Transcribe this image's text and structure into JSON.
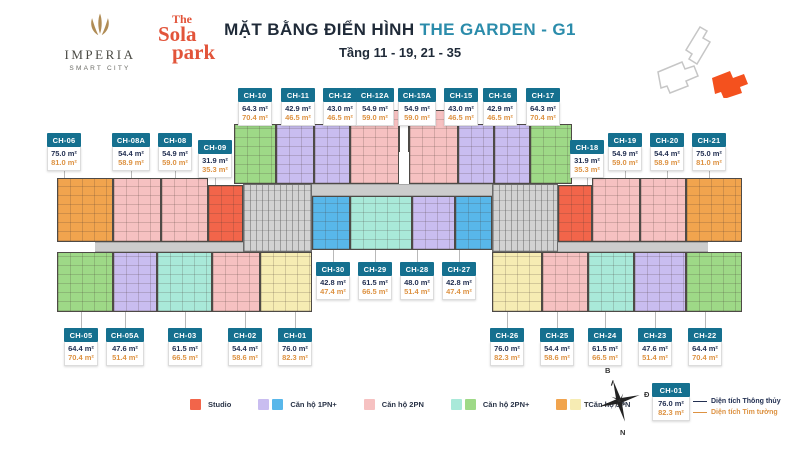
{
  "header": {
    "imperia_name": "IMPERIA",
    "imperia_sub": "SMART CITY",
    "sola_l1": "The",
    "sola_l2": "Sola",
    "sola_l3": "park",
    "title_black": "MẶT BẰNG ĐIỂN HÌNH",
    "title_teal": "THE GARDEN - G1",
    "subtitle": "Tầng 11 - 19, 21 - 35"
  },
  "palette": {
    "studio": "#f2654a",
    "1pn_purple": "#c9bdf0",
    "1pn_blue": "#58b7ea",
    "2pn_pink": "#f6c1c1",
    "2pnp_cyan": "#a9e9d9",
    "2pnp_green": "#9ed987",
    "3pn_orange": "#f1a44e",
    "3pn_yellow": "#f6ecb3",
    "label_teal": "#15708f",
    "net_navy": "#233052",
    "gross_orange": "#dd9242",
    "site_highlight": "#f4511e"
  },
  "plan": {
    "units": [
      {
        "code": "CH-10",
        "net": "64.3 m²",
        "gross": "70.4 m²",
        "type": "2pnp_green",
        "label": {
          "x": 238,
          "y": 88,
          "w": 34,
          "pos": "above"
        },
        "rect": {
          "x": 234,
          "y": 124,
          "w": 42,
          "h": 60
        }
      },
      {
        "code": "CH-11",
        "net": "42.9 m²",
        "gross": "46.5 m²",
        "type": "1pn_purple",
        "label": {
          "x": 281,
          "y": 88,
          "w": 34,
          "pos": "above"
        },
        "rect": {
          "x": 276,
          "y": 124,
          "w": 38,
          "h": 60
        }
      },
      {
        "code": "CH-12",
        "net": "43.0 m²",
        "gross": "46.5 m²",
        "type": "1pn_purple",
        "label": {
          "x": 323,
          "y": 88,
          "w": 34,
          "pos": "above"
        },
        "rect": {
          "x": 314,
          "y": 124,
          "w": 36,
          "h": 60
        }
      },
      {
        "code": "CH-12A",
        "net": "54.9 m²",
        "gross": "59.0 m²",
        "type": "2pn_pink",
        "label": {
          "x": 356,
          "y": 88,
          "w": 38,
          "pos": "above"
        },
        "rect": {
          "x": 350,
          "y": 110,
          "w": 49,
          "h": 74
        }
      },
      {
        "code": "CH-15A",
        "net": "54.9 m²",
        "gross": "59.0 m²",
        "type": "2pn_pink",
        "label": {
          "x": 398,
          "y": 88,
          "w": 38,
          "pos": "above"
        },
        "rect": {
          "x": 409,
          "y": 110,
          "w": 49,
          "h": 74
        }
      },
      {
        "code": "CH-15",
        "net": "43.0 m²",
        "gross": "46.5 m²",
        "type": "1pn_purple",
        "label": {
          "x": 444,
          "y": 88,
          "w": 34,
          "pos": "above"
        },
        "rect": {
          "x": 458,
          "y": 124,
          "w": 36,
          "h": 60
        }
      },
      {
        "code": "CH-16",
        "net": "42.9 m²",
        "gross": "46.5 m²",
        "type": "1pn_purple",
        "label": {
          "x": 483,
          "y": 88,
          "w": 34,
          "pos": "above"
        },
        "rect": {
          "x": 494,
          "y": 124,
          "w": 36,
          "h": 60
        }
      },
      {
        "code": "CH-17",
        "net": "64.3 m²",
        "gross": "70.4 m²",
        "type": "2pnp_green",
        "label": {
          "x": 526,
          "y": 88,
          "w": 34,
          "pos": "above"
        },
        "rect": {
          "x": 530,
          "y": 124,
          "w": 42,
          "h": 60
        }
      },
      {
        "code": "CH-06",
        "net": "75.0 m²",
        "gross": "81.0 m²",
        "type": "3pn_orange",
        "label": {
          "x": 47,
          "y": 133,
          "w": 34,
          "pos": "above"
        },
        "rect": {
          "x": 57,
          "y": 178,
          "w": 56,
          "h": 64
        }
      },
      {
        "code": "CH-08A",
        "net": "54.4 m²",
        "gross": "58.9 m²",
        "type": "2pn_pink",
        "label": {
          "x": 112,
          "y": 133,
          "w": 38,
          "pos": "above"
        },
        "rect": {
          "x": 113,
          "y": 178,
          "w": 48,
          "h": 64
        }
      },
      {
        "code": "CH-08",
        "net": "54.9 m²",
        "gross": "59.0 m²",
        "type": "2pn_pink",
        "label": {
          "x": 158,
          "y": 133,
          "w": 34,
          "pos": "above"
        },
        "rect": {
          "x": 161,
          "y": 178,
          "w": 47,
          "h": 64
        }
      },
      {
        "code": "CH-09",
        "net": "31.9 m²",
        "gross": "35.3 m²",
        "type": "studio",
        "label": {
          "x": 198,
          "y": 140,
          "w": 34,
          "pos": "above"
        },
        "rect": {
          "x": 208,
          "y": 185,
          "w": 35,
          "h": 57
        }
      },
      {
        "code": "CH-18",
        "net": "31.9 m²",
        "gross": "35.3 m²",
        "type": "studio",
        "label": {
          "x": 570,
          "y": 140,
          "w": 34,
          "pos": "above"
        },
        "rect": {
          "x": 558,
          "y": 185,
          "w": 34,
          "h": 57
        }
      },
      {
        "code": "CH-19",
        "net": "54.9 m²",
        "gross": "59.0 m²",
        "type": "2pn_pink",
        "label": {
          "x": 608,
          "y": 133,
          "w": 34,
          "pos": "above"
        },
        "rect": {
          "x": 592,
          "y": 178,
          "w": 48,
          "h": 64
        }
      },
      {
        "code": "CH-20",
        "net": "54.4 m²",
        "gross": "58.9 m²",
        "type": "2pn_pink",
        "label": {
          "x": 650,
          "y": 133,
          "w": 34,
          "pos": "above"
        },
        "rect": {
          "x": 640,
          "y": 178,
          "w": 46,
          "h": 64
        }
      },
      {
        "code": "CH-21",
        "net": "75.0 m²",
        "gross": "81.0 m²",
        "type": "3pn_orange",
        "label": {
          "x": 692,
          "y": 133,
          "w": 34,
          "pos": "above"
        },
        "rect": {
          "x": 686,
          "y": 178,
          "w": 56,
          "h": 64
        }
      },
      {
        "code": "CH-30",
        "net": "42.8 m²",
        "gross": "47.4 m²",
        "type": "1pn_blue",
        "label": {
          "x": 316,
          "y": 262,
          "w": 34,
          "pos": "below"
        },
        "rect": {
          "x": 312,
          "y": 196,
          "w": 38,
          "h": 54
        }
      },
      {
        "code": "CH-29",
        "net": "61.5 m²",
        "gross": "66.5 m²",
        "type": "2pnp_cyan",
        "label": {
          "x": 358,
          "y": 262,
          "w": 34,
          "pos": "below"
        },
        "rect": {
          "x": 350,
          "y": 196,
          "w": 62,
          "h": 54
        }
      },
      {
        "code": "CH-28",
        "net": "48.0 m²",
        "gross": "51.4 m²",
        "type": "1pn_purple",
        "label": {
          "x": 400,
          "y": 262,
          "w": 34,
          "pos": "below"
        },
        "rect": {
          "x": 412,
          "y": 196,
          "w": 43,
          "h": 54
        }
      },
      {
        "code": "CH-27",
        "net": "42.8 m²",
        "gross": "47.4 m²",
        "type": "1pn_blue",
        "label": {
          "x": 442,
          "y": 262,
          "w": 34,
          "pos": "below"
        },
        "rect": {
          "x": 455,
          "y": 196,
          "w": 37,
          "h": 54
        }
      },
      {
        "code": "CH-05",
        "net": "64.4 m²",
        "gross": "70.4 m²",
        "type": "2pnp_green",
        "label": {
          "x": 64,
          "y": 328,
          "w": 34,
          "pos": "below"
        },
        "rect": {
          "x": 57,
          "y": 252,
          "w": 56,
          "h": 60
        }
      },
      {
        "code": "CH-05A",
        "net": "47.6 m²",
        "gross": "51.4 m²",
        "type": "1pn_purple",
        "label": {
          "x": 106,
          "y": 328,
          "w": 38,
          "pos": "below"
        },
        "rect": {
          "x": 113,
          "y": 252,
          "w": 44,
          "h": 60
        }
      },
      {
        "code": "CH-03",
        "net": "61.5 m²",
        "gross": "66.5 m²",
        "type": "2pnp_cyan",
        "label": {
          "x": 168,
          "y": 328,
          "w": 34,
          "pos": "below"
        },
        "rect": {
          "x": 157,
          "y": 252,
          "w": 55,
          "h": 60
        }
      },
      {
        "code": "CH-02",
        "net": "54.4 m²",
        "gross": "58.6 m²",
        "type": "2pn_pink",
        "label": {
          "x": 228,
          "y": 328,
          "w": 34,
          "pos": "below"
        },
        "rect": {
          "x": 212,
          "y": 252,
          "w": 48,
          "h": 60
        }
      },
      {
        "code": "CH-01",
        "net": "76.0 m²",
        "gross": "82.3 m²",
        "type": "3pn_yellow",
        "label": {
          "x": 278,
          "y": 328,
          "w": 34,
          "pos": "below"
        },
        "rect": {
          "x": 260,
          "y": 252,
          "w": 52,
          "h": 60
        }
      },
      {
        "code": "CH-26",
        "net": "76.0 m²",
        "gross": "82.3 m²",
        "type": "3pn_yellow",
        "label": {
          "x": 490,
          "y": 328,
          "w": 34,
          "pos": "below"
        },
        "rect": {
          "x": 492,
          "y": 252,
          "w": 50,
          "h": 60
        }
      },
      {
        "code": "CH-25",
        "net": "54.4 m²",
        "gross": "58.6 m²",
        "type": "2pn_pink",
        "label": {
          "x": 540,
          "y": 328,
          "w": 34,
          "pos": "below"
        },
        "rect": {
          "x": 542,
          "y": 252,
          "w": 46,
          "h": 60
        }
      },
      {
        "code": "CH-24",
        "net": "61.5 m²",
        "gross": "66.5 m²",
        "type": "2pnp_cyan",
        "label": {
          "x": 588,
          "y": 328,
          "w": 34,
          "pos": "below"
        },
        "rect": {
          "x": 588,
          "y": 252,
          "w": 46,
          "h": 60
        }
      },
      {
        "code": "CH-23",
        "net": "47.6 m²",
        "gross": "51.4 m²",
        "type": "1pn_purple",
        "label": {
          "x": 638,
          "y": 328,
          "w": 34,
          "pos": "below"
        },
        "rect": {
          "x": 634,
          "y": 252,
          "w": 52,
          "h": 60
        }
      },
      {
        "code": "CH-22",
        "net": "64.4 m²",
        "gross": "70.4 m²",
        "type": "2pnp_green",
        "label": {
          "x": 688,
          "y": 328,
          "w": 34,
          "pos": "below"
        },
        "rect": {
          "x": 686,
          "y": 252,
          "w": 56,
          "h": 60
        }
      }
    ],
    "structure": [
      {
        "kind": "core",
        "x": 243,
        "y": 184,
        "w": 69,
        "h": 68
      },
      {
        "kind": "core",
        "x": 492,
        "y": 184,
        "w": 66,
        "h": 68
      },
      {
        "kind": "corridor",
        "x": 95,
        "y": 242,
        "w": 148,
        "h": 10
      },
      {
        "kind": "corridor",
        "x": 558,
        "y": 242,
        "w": 150,
        "h": 10
      },
      {
        "kind": "corridor",
        "x": 312,
        "y": 184,
        "w": 180,
        "h": 12
      }
    ],
    "notches": [
      {
        "x": 399,
        "y": 110,
        "w": 10,
        "h": 42
      }
    ]
  },
  "legend": {
    "items": [
      {
        "label": "Studio",
        "swatches": [
          "studio"
        ]
      },
      {
        "label": "Căn hộ 1PN+",
        "swatches": [
          "1pn_purple",
          "1pn_blue"
        ]
      },
      {
        "label": "Căn hộ 2PN",
        "swatches": [
          "2pn_pink"
        ]
      },
      {
        "label": "Căn hộ 2PN+",
        "swatches": [
          "2pnp_cyan",
          "2pnp_green"
        ]
      },
      {
        "label": "Căn hộ 3PN",
        "swatches": [
          "3pn_orange",
          "3pn_yellow"
        ]
      }
    ]
  },
  "area_key": {
    "code": "CH-01",
    "net": "76.0 m²",
    "gross": "82.3 m²",
    "net_label": "Diện tích Thông thủy",
    "gross_label": "Diện tích Tim tường"
  },
  "compass": {
    "north": "B",
    "east": "Đ",
    "south": "N",
    "west": "T"
  }
}
